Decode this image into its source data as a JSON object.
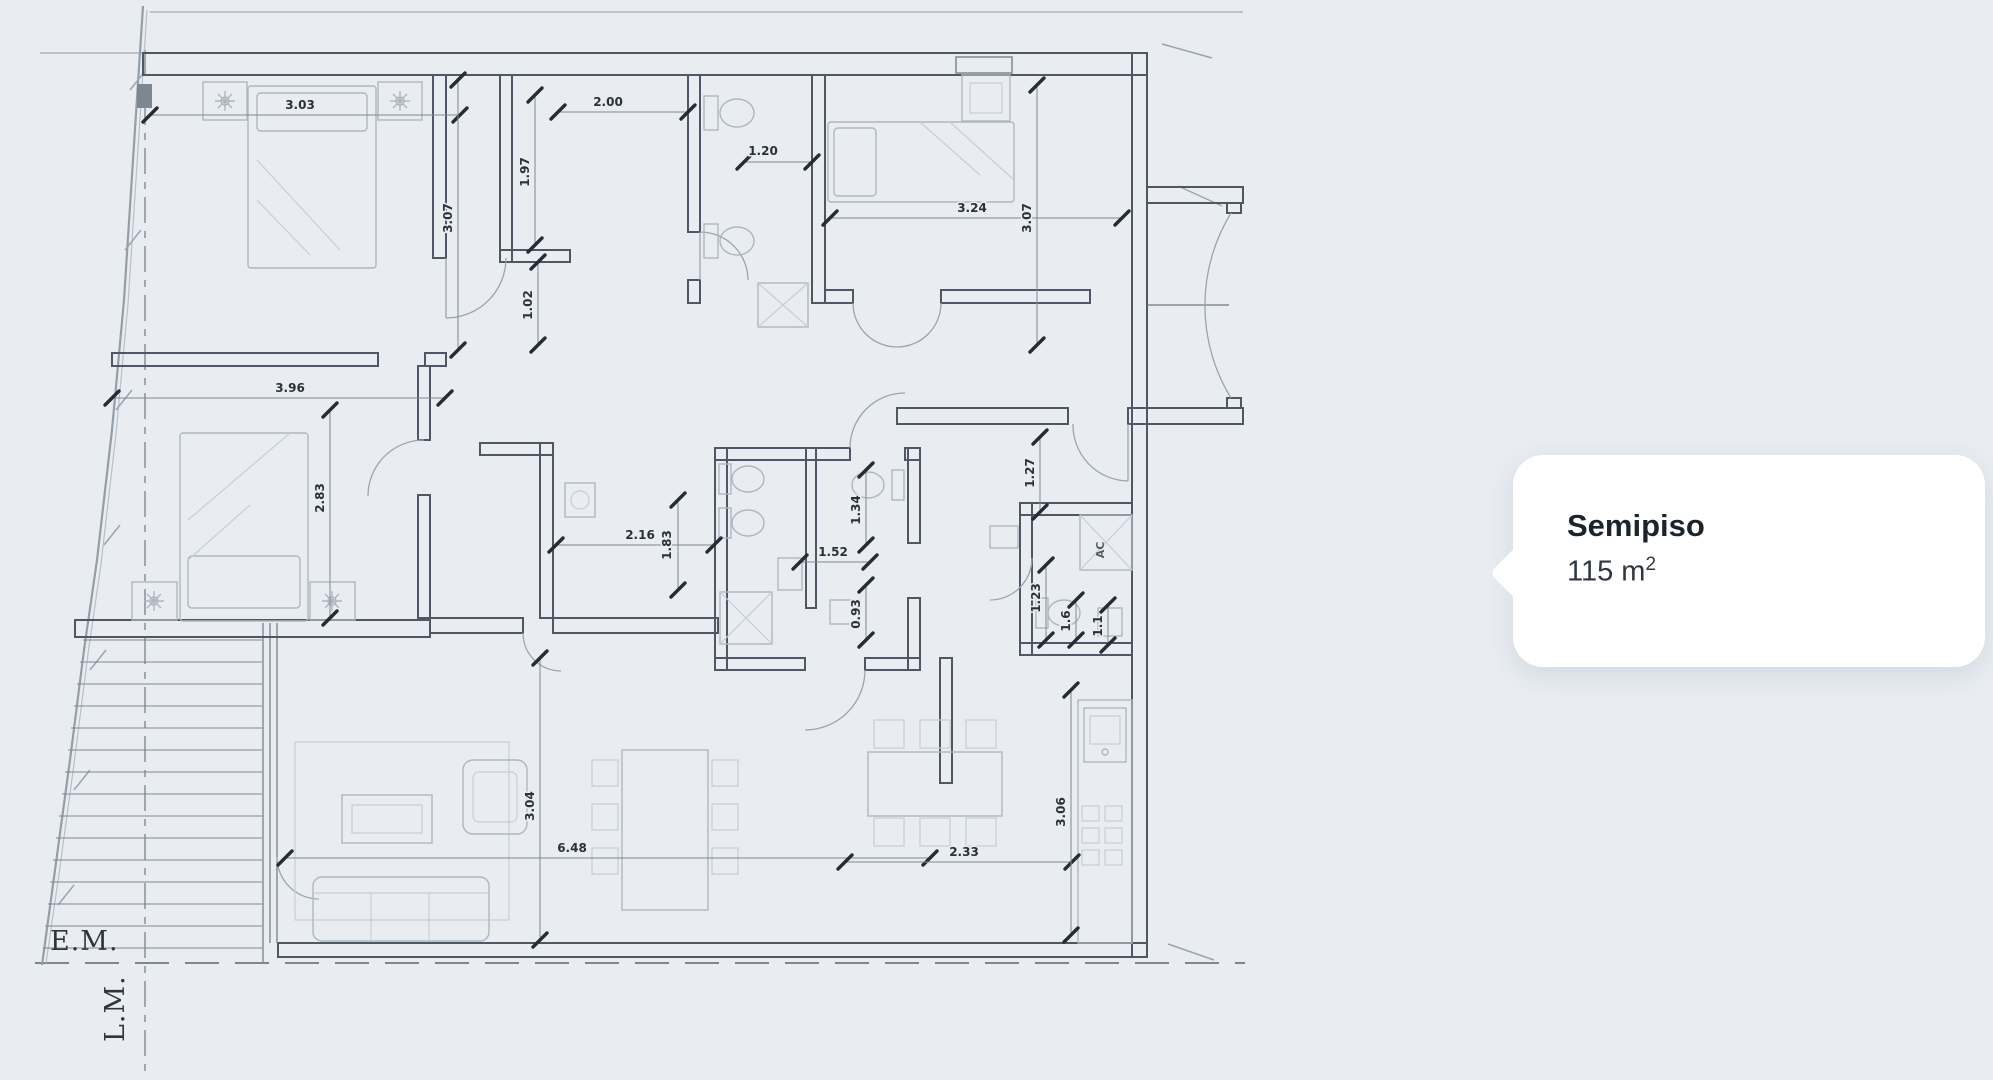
{
  "page": {
    "background": "#e9edf2"
  },
  "card": {
    "title": "Semipiso",
    "area_value": "115",
    "area_unit_base": "m",
    "area_unit_exp": "2",
    "bg": "#ffffff"
  },
  "plan": {
    "boundary_labels": [
      {
        "text": "E.M.",
        "x": 50,
        "y": 950,
        "rot": 0
      },
      {
        "text": "L.M.",
        "x": 124,
        "y": 1042,
        "rot": -90
      }
    ],
    "room_notes": [
      {
        "text": "AC",
        "x": 1104,
        "y": 550,
        "rot": -90
      }
    ],
    "dimensions": [
      {
        "label": "3.03",
        "line": [
          150,
          115,
          460,
          115
        ],
        "lx": 300,
        "ly": 109,
        "rot": 0
      },
      {
        "label": "2.00",
        "line": [
          558,
          112,
          688,
          112
        ],
        "lx": 608,
        "ly": 106,
        "rot": 0
      },
      {
        "label": "1.97",
        "line": [
          535,
          95,
          535,
          245
        ],
        "lx": 529,
        "ly": 172,
        "rot": -90
      },
      {
        "label": "3.07",
        "line": [
          458,
          80,
          458,
          350
        ],
        "lx": 452,
        "ly": 218,
        "rot": -90
      },
      {
        "label": "1.20",
        "line": [
          744,
          162,
          812,
          162
        ],
        "lx": 763,
        "ly": 155,
        "rot": 0
      },
      {
        "label": "3.24",
        "line": [
          830,
          218,
          1122,
          218
        ],
        "lx": 972,
        "ly": 212,
        "rot": 0
      },
      {
        "label": "3.07",
        "line": [
          1037,
          85,
          1037,
          345
        ],
        "lx": 1031,
        "ly": 218,
        "rot": -90
      },
      {
        "label": "1.02",
        "line": [
          538,
          262,
          538,
          345
        ],
        "lx": 532,
        "ly": 305,
        "rot": -90
      },
      {
        "label": "3.96",
        "line": [
          112,
          398,
          445,
          398
        ],
        "lx": 290,
        "ly": 392,
        "rot": 0
      },
      {
        "label": "2.83",
        "line": [
          330,
          410,
          330,
          618
        ],
        "lx": 324,
        "ly": 498,
        "rot": -90
      },
      {
        "label": "2.16",
        "line": [
          556,
          545,
          714,
          545
        ],
        "lx": 640,
        "ly": 539,
        "rot": 0
      },
      {
        "label": "1.83",
        "line": [
          678,
          500,
          678,
          590
        ],
        "lx": 671,
        "ly": 545,
        "rot": -90
      },
      {
        "label": "1.52",
        "line": [
          800,
          562,
          870,
          562
        ],
        "lx": 833,
        "ly": 556,
        "rot": 0
      },
      {
        "label": "1.34",
        "line": [
          866,
          470,
          866,
          545
        ],
        "lx": 860,
        "ly": 510,
        "rot": -90
      },
      {
        "label": "0.93",
        "line": [
          866,
          585,
          866,
          640
        ],
        "lx": 860,
        "ly": 614,
        "rot": -90
      },
      {
        "label": "1.27",
        "line": [
          1040,
          437,
          1040,
          512
        ],
        "lx": 1034,
        "ly": 473,
        "rot": -90
      },
      {
        "label": "1.23",
        "line": [
          1046,
          565,
          1046,
          640
        ],
        "lx": 1040,
        "ly": 598,
        "rot": -90
      },
      {
        "label": "1.6",
        "line": [
          1076,
          600,
          1076,
          640
        ],
        "lx": 1070,
        "ly": 621,
        "rot": -90
      },
      {
        "label": "1.1",
        "line": [
          1108,
          605,
          1108,
          645
        ],
        "lx": 1102,
        "ly": 626,
        "rot": -90
      },
      {
        "label": "3.04",
        "line": [
          540,
          658,
          540,
          940
        ],
        "lx": 534,
        "ly": 806,
        "rot": -90
      },
      {
        "label": "6.48",
        "line": [
          285,
          858,
          930,
          858
        ],
        "lx": 572,
        "ly": 852,
        "rot": 0
      },
      {
        "label": "2.33",
        "line": [
          845,
          862,
          1072,
          862
        ],
        "lx": 964,
        "ly": 856,
        "rot": 0
      },
      {
        "label": "3.06",
        "line": [
          1071,
          690,
          1071,
          935
        ],
        "lx": 1065,
        "ly": 812,
        "rot": -90
      }
    ]
  },
  "colors": {
    "background": "#e9edf2",
    "wall": "#4e5763",
    "dim_tick": "#262c33",
    "card_bg": "#ffffff",
    "text_dark": "#1d232b"
  }
}
